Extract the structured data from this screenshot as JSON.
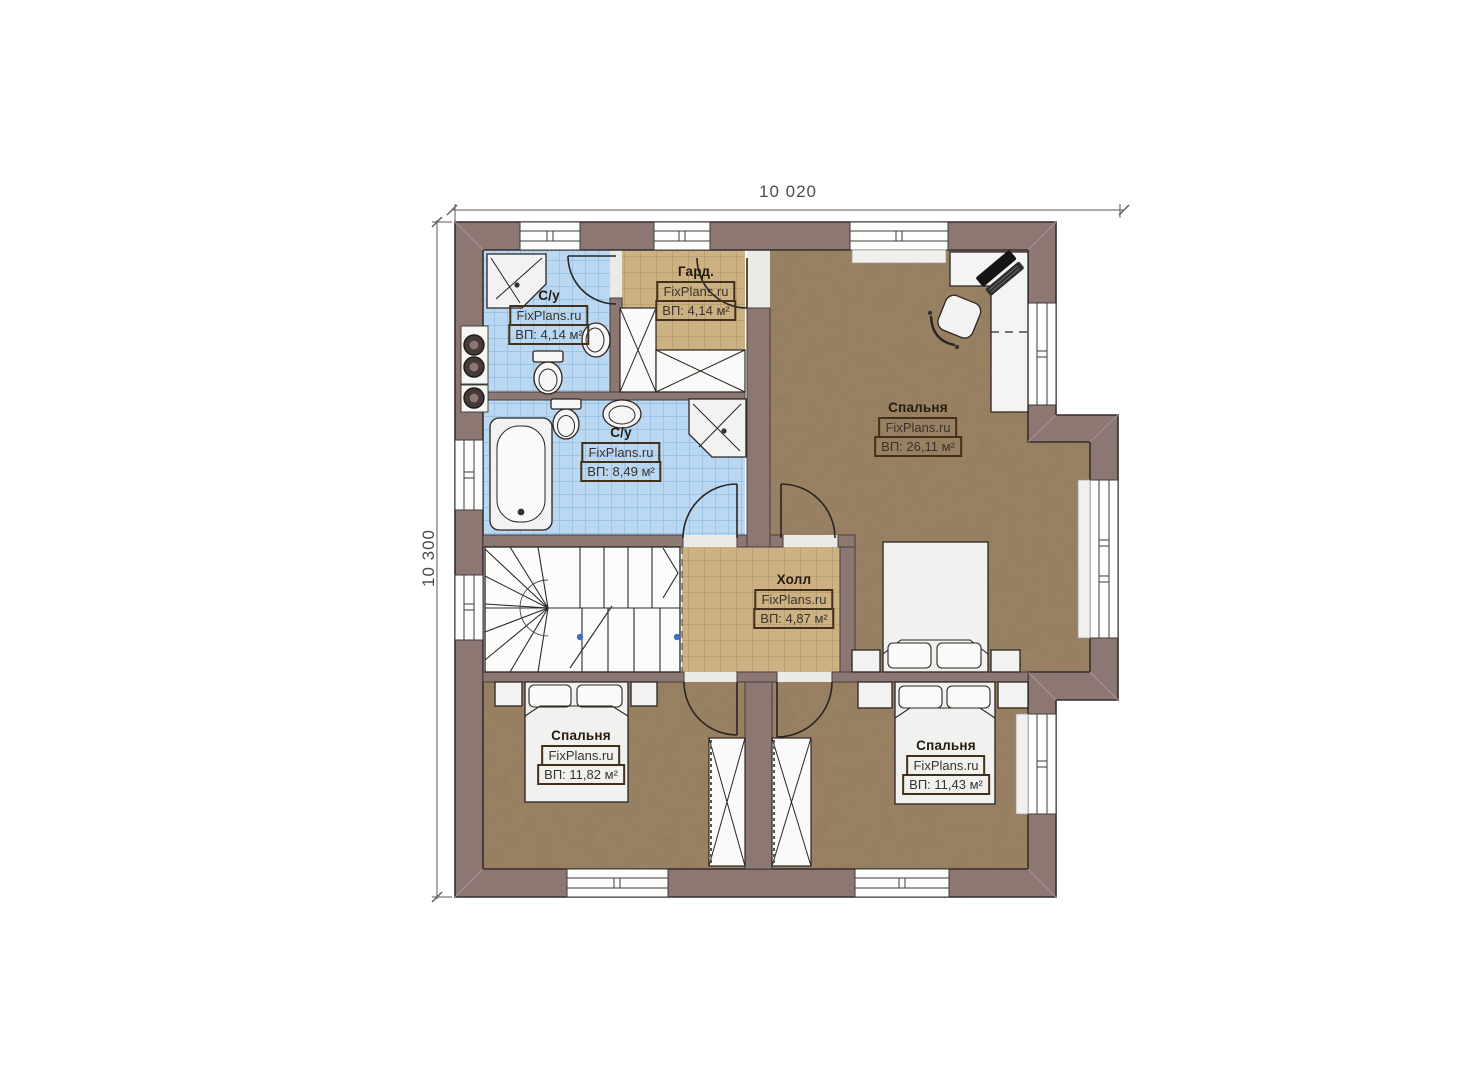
{
  "plan": {
    "floor_type": "second-floor-plan",
    "brand": "FixPlans.ru"
  },
  "dimensions": {
    "width": "10 020",
    "height": "10 300"
  },
  "rooms": {
    "bathroom_top": {
      "name": "С/у",
      "brand": "FixPlans.ru",
      "area": "ВП: 4,14 м²"
    },
    "wardrobe": {
      "name": "Гард.",
      "brand": "FixPlans.ru",
      "area": "ВП: 4,14 м²"
    },
    "bathroom_main": {
      "name": "С/у",
      "brand": "FixPlans.ru",
      "area": "ВП: 8,49 м²"
    },
    "bedroom_master": {
      "name": "Спальня",
      "brand": "FixPlans.ru",
      "area": "ВП: 26,11 м²"
    },
    "hall": {
      "name": "Холл",
      "brand": "FixPlans.ru",
      "area": "ВП: 4,87 м²"
    },
    "bedroom_left": {
      "name": "Спальня",
      "brand": "FixPlans.ru",
      "area": "ВП: 11,82 м²"
    },
    "bedroom_right": {
      "name": "Спальня",
      "brand": "FixPlans.ru",
      "area": "ВП: 11,43 м²"
    }
  },
  "colors": {
    "wall": "#8d7773",
    "bathroom_tile": "#bad8f1",
    "hall_tile": "#ccb183",
    "bedroom_floor": "#9b8364",
    "fixture": "#f2f2f0",
    "window": "#fdfdfc"
  }
}
